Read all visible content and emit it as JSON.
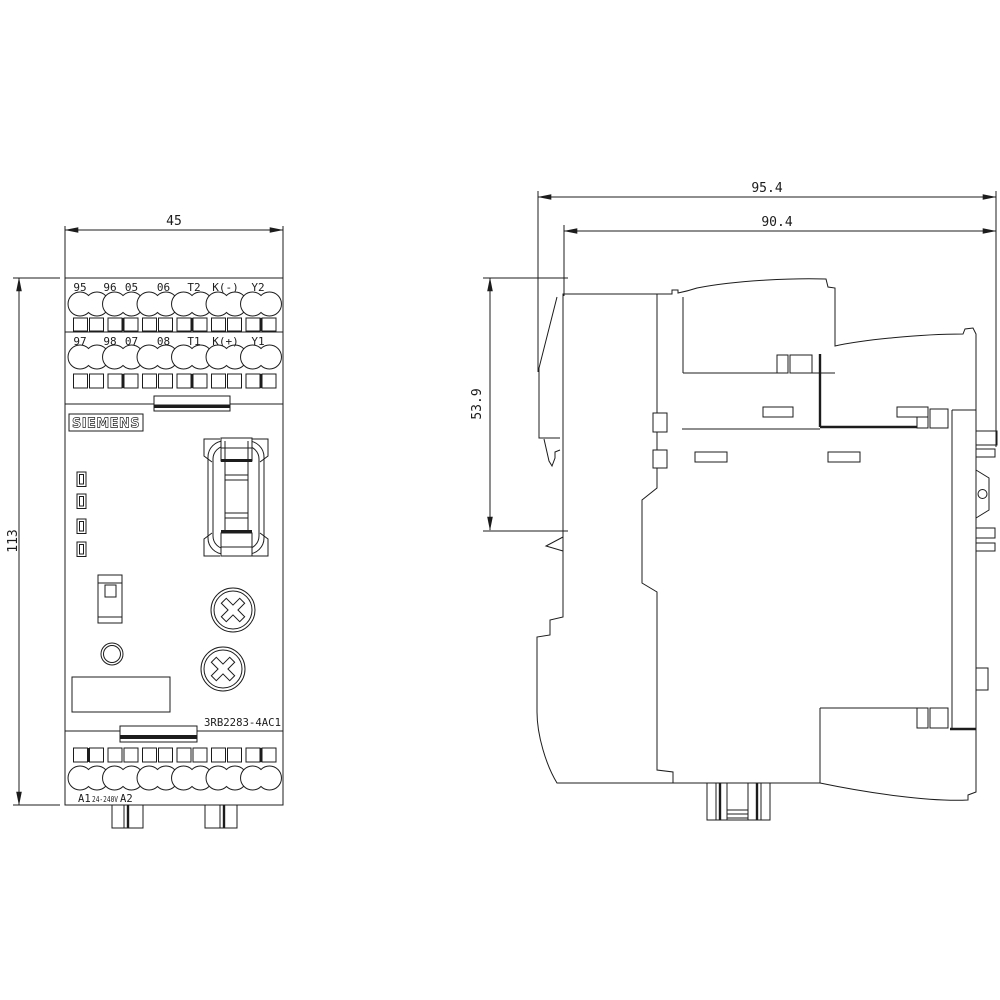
{
  "brand_label": "SIEMENS",
  "product_code": "3RB2283-4AC1",
  "dimensions": {
    "front_width": "45",
    "front_height": "113",
    "side_total_depth": "95.4",
    "side_body_depth": "90.4",
    "side_upper_depth": "53.9"
  },
  "terminals": {
    "row1": [
      "95",
      "96",
      "05",
      "06",
      "T2",
      "K(-)",
      "Y2"
    ],
    "row2": [
      "97",
      "98",
      "07",
      "08",
      "T1",
      "K(+)",
      "Y1"
    ],
    "bottom": {
      "a1": "A1",
      "voltage": "24-240V",
      "a2": "A2"
    }
  }
}
